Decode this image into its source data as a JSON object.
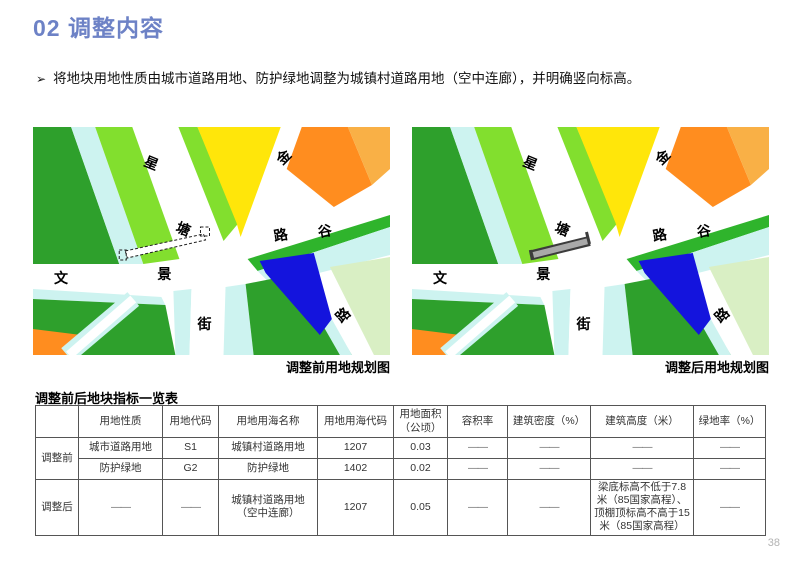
{
  "header": {
    "title": "02 调整内容"
  },
  "bullet": {
    "marker": "➢",
    "text": "将地块用地性质由城市道路用地、防护绿地调整为城镇村道路用地（空中连廊），并明确竖向标高。"
  },
  "maps": {
    "road_labels": [
      "星",
      "塘",
      "金",
      "路",
      "谷",
      "文",
      "景",
      "街",
      "路"
    ],
    "before": {
      "caption": "调整前用地规划图"
    },
    "after": {
      "caption": "调整后用地规划图"
    }
  },
  "colors": {
    "title_accent": "#6d82c6",
    "darkGreen": "#2ea02c",
    "midGreen": "#2fb42c",
    "lightGreen": "#82df2e",
    "paleGreen": "#d9efc4",
    "cyan": "#cdf3f0",
    "yellow": "#ffe60a",
    "orange": "#ff8d1f",
    "lightOrange": "#f9b046",
    "blue": "#1414dd",
    "corridor_gray": "#a9a9a9"
  },
  "table": {
    "title": "调整前后地块指标一览表",
    "headers": [
      "",
      "用地性质",
      "用地代码",
      "用地用海名称",
      "用地用海代码",
      "用地面积（公顷）",
      "容积率",
      "建筑密度（%）",
      "建筑高度（米）",
      "绿地率（%）"
    ],
    "rows": [
      {
        "group": "调整前",
        "cells": [
          "城市道路用地",
          "S1",
          "城镇村道路用地",
          "1207",
          "0.03",
          "——",
          "——",
          "——",
          "——"
        ]
      },
      {
        "group": "",
        "cells": [
          "防护绿地",
          "G2",
          "防护绿地",
          "1402",
          "0.02",
          "——",
          "——",
          "——",
          "——"
        ]
      },
      {
        "group": "调整后",
        "cells": [
          "——",
          "——",
          "城镇村道路用地（空中连廊）",
          "1207",
          "0.05",
          "——",
          "——",
          "梁底标高不低于7.8米（85国家高程）、顶棚顶标高不高于15米（85国家高程）",
          "——"
        ]
      }
    ]
  },
  "page": {
    "number": "38"
  }
}
